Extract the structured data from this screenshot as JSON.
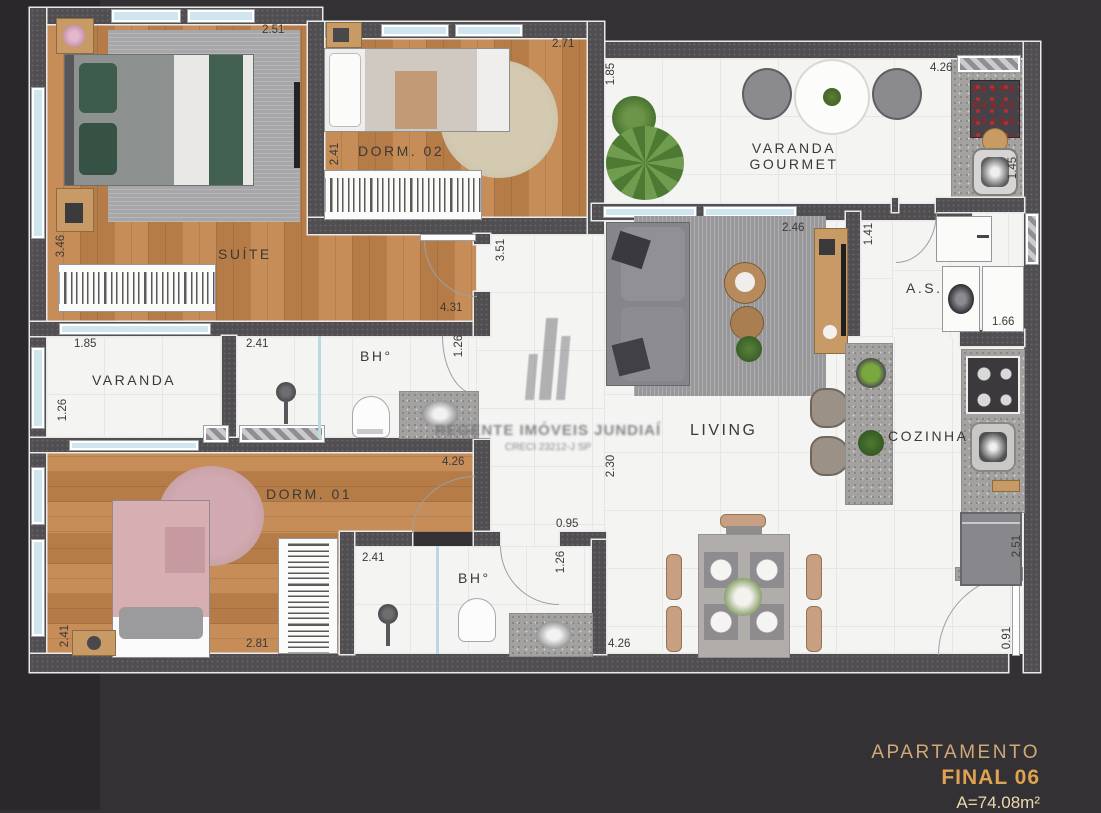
{
  "plan": {
    "rooms": {
      "suite": "SUÍTE",
      "dorm02": "DORM. 02",
      "varanda_gourmet_line1": "VARANDA",
      "varanda_gourmet_line2": "GOURMET",
      "service_area": "A.S.",
      "living": "LIVING",
      "kitchen": "COZINHA",
      "varanda": "VARANDA",
      "bath1": "BH°",
      "bath2": "BH°",
      "dorm01": "DORM. 01"
    },
    "dims": {
      "suite_top": "2.51",
      "suite_left": "3.46",
      "suite_bottom": "4.31",
      "dorm02_top": "2.71",
      "dorm02_left": "2.41",
      "vg_left": "1.85",
      "vg_top": "4.26",
      "gourmet_right": "1.45",
      "living_top": "2.46",
      "cabinet": "1.41",
      "service_right": "1.66",
      "hall": "3.51",
      "varanda_top": "1.85",
      "varanda_left": "1.26",
      "bath1_shower": "2.41",
      "bath1_door": "1.26",
      "living_left": "2.30",
      "dorm01_top": "4.26",
      "dorm01_left": "2.41",
      "dorm01_bottom": "2.81",
      "bath2_top": "0.95",
      "bath2_shower": "2.41",
      "bath2_door": "1.26",
      "dining_bottom": "4.26",
      "kitchen_right": "2.51",
      "entry": "0.91"
    }
  },
  "watermark": {
    "company": "REGENTE IMÓVEIS JUNDIAÍ",
    "creci": "CRECI 23212-J SP"
  },
  "title_block": {
    "line1": "APARTAMENTO",
    "line2": "FINAL 06",
    "line3": "A=74.08m²"
  },
  "colors": {
    "accent_gold": "#dfa251",
    "wall": "#514e52",
    "wood": "#bd8453",
    "tile": "#f4f4f3",
    "window_glass": "#cfe6ee"
  }
}
